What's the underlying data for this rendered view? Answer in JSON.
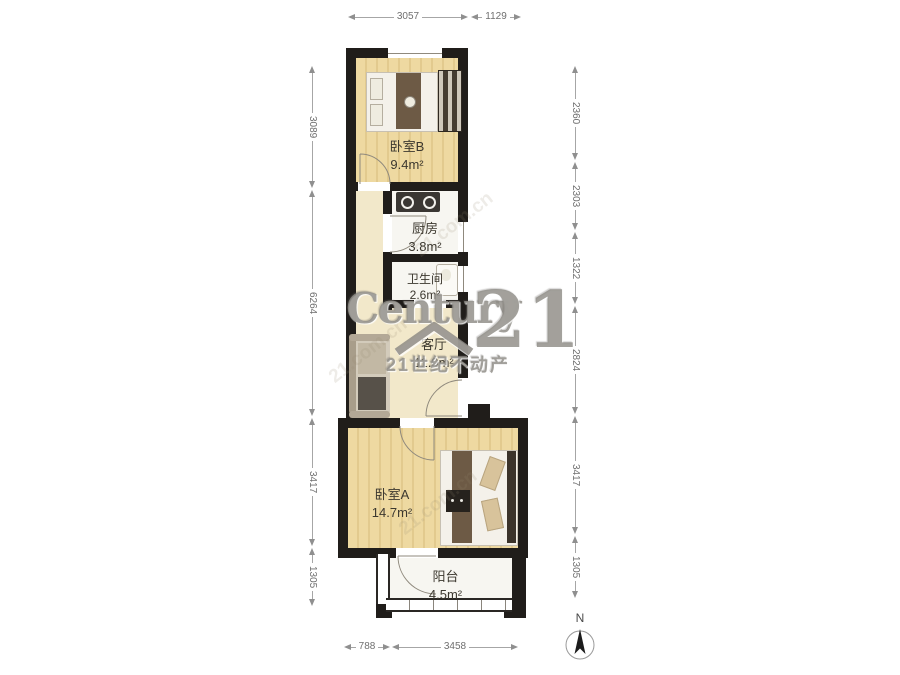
{
  "plan": {
    "rooms": {
      "bedroom_b": {
        "name": "卧室B",
        "area": "9.4m²"
      },
      "kitchen": {
        "name": "厨房",
        "area": "3.8m²"
      },
      "bathroom": {
        "name": "卫生间",
        "area": "2.6m²"
      },
      "living_room": {
        "name": "客厅",
        "area": "11.9m²"
      },
      "bedroom_a": {
        "name": "卧室A",
        "area": "14.7m²"
      },
      "balcony": {
        "name": "阳台",
        "area": "4.5m²"
      }
    },
    "dimensions_mm": {
      "top": [
        "3057",
        "1129"
      ],
      "bottom": [
        "788",
        "3458"
      ],
      "left": [
        "3089",
        "6264",
        "3417",
        "1305"
      ],
      "right": [
        "2360",
        "2303",
        "1322",
        "2824",
        "3417",
        "1305"
      ]
    },
    "compass": {
      "north_label": "N"
    }
  },
  "watermark": {
    "brand": "Century",
    "brand_number": "21",
    "chinese_name": "21世纪不动产",
    "tile": "21.com.cn"
  },
  "colors": {
    "wall": "#201d1a",
    "wood_floor": "#eed9a1",
    "cream_floor": "#f2e8ca",
    "white_floor": "#f7f6f1",
    "dimension_line": "#8f8f8f",
    "room_label": "#3c382f",
    "watermark": "#8f8c86"
  }
}
